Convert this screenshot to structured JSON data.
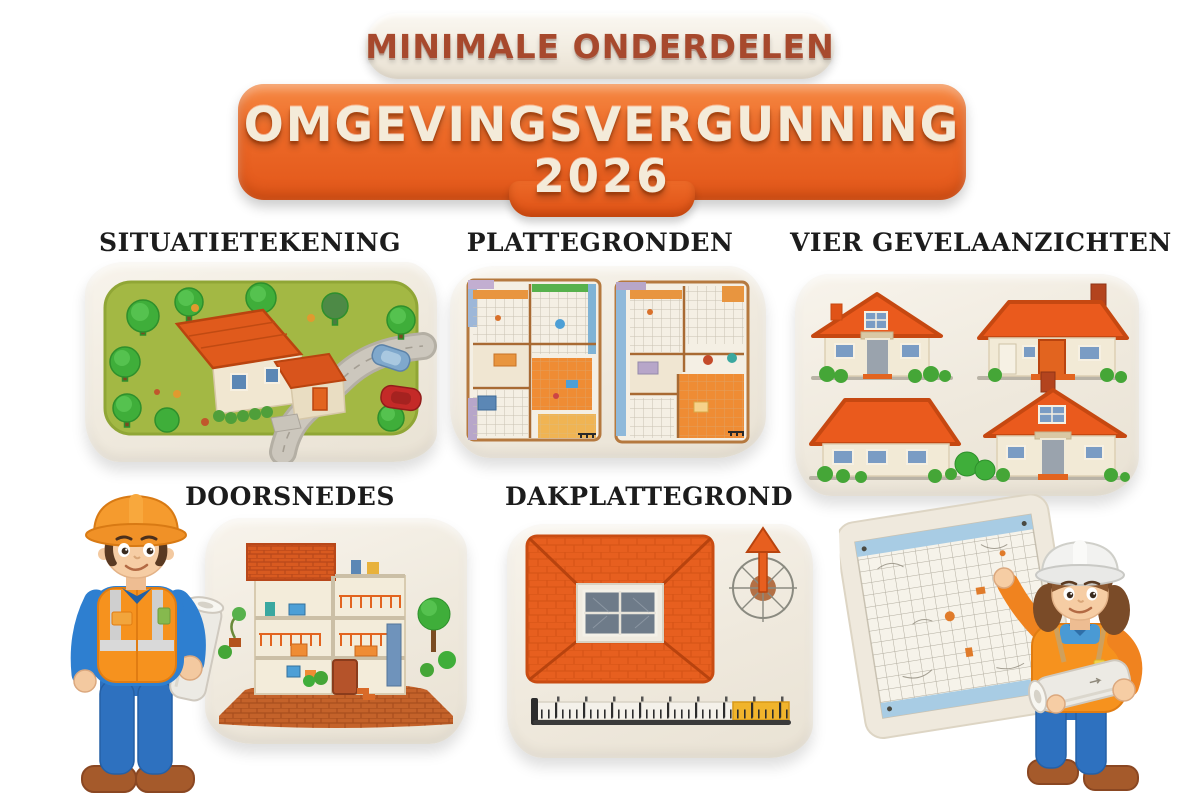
{
  "header": {
    "subtitle": "MINIMALE ONDERDELEN",
    "title": "OMGEVINGSVERGUNNING",
    "year": "2026"
  },
  "sections": [
    {
      "label": "SITUATIETEKENING"
    },
    {
      "label": "PLATTEGRONDEN"
    },
    {
      "label": "VIER GEVELAANZICHTEN"
    },
    {
      "label": "DOORSNEDES"
    },
    {
      "label": "DAKPLATTEGROND"
    }
  ],
  "illustrations": [
    "site-plan-with-house-trees-road-cars",
    "two-colored-floor-plans",
    "four-house-elevation-views",
    "house-cross-section",
    "roof-plan-with-compass-and-ruler",
    "male-construction-worker-with-blueprint-roll",
    "female-construction-worker-pointing-at-grid-plan"
  ],
  "colors": {
    "banner_orange": "#e8611f",
    "banner_text_cream": "#f4ebd9",
    "subtitle_brown": "#a7492d",
    "label_black": "#1c1c1c",
    "tablet_cream": "#f1ece3",
    "roof_orange": "#e75f1f",
    "grass_green": "#a3b844",
    "tree_green": "#3fae3a",
    "vest_orange": "#f6921e",
    "worker_blue": "#2e71bf",
    "boot_brown": "#a55a2b",
    "ruler_yellow": "#f0b42c",
    "plan_blue": "#a8cce4"
  }
}
